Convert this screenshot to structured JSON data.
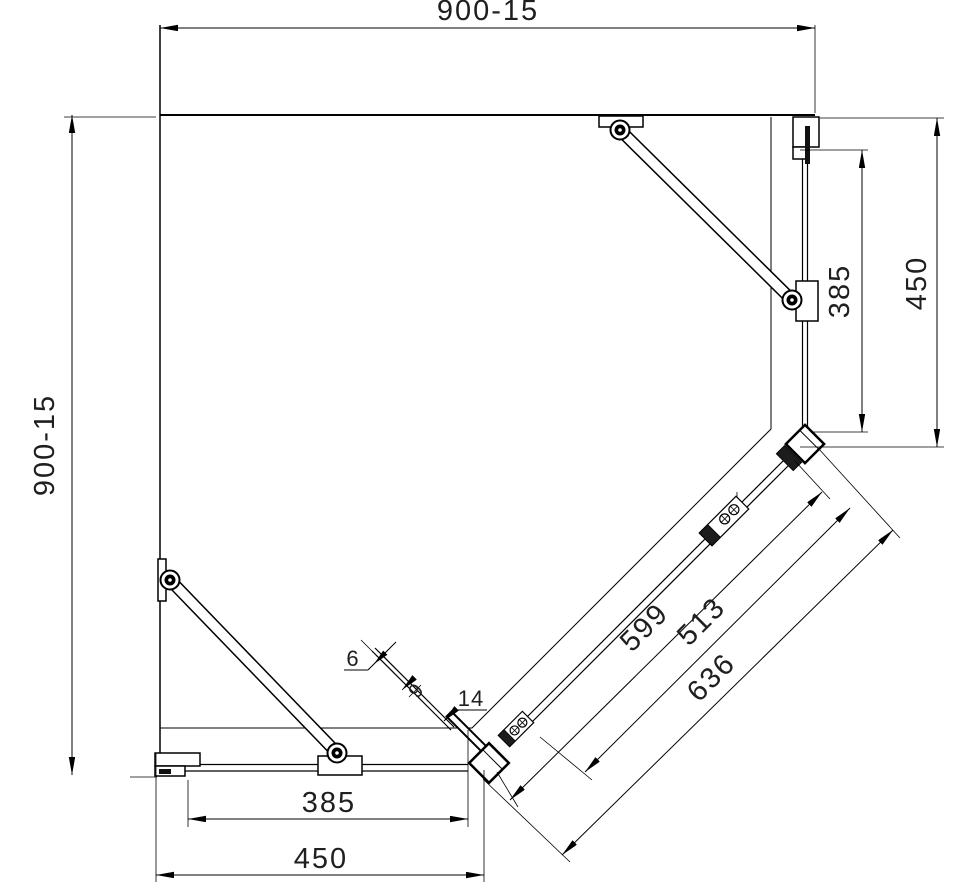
{
  "drawing": {
    "type": "technical-plan-drawing",
    "subject": "pentagon corner shower enclosure plan view",
    "units_implied": "mm",
    "colors": {
      "line": "#000000",
      "background": "#ffffff",
      "text": "#1f1f1f"
    },
    "dimensions": {
      "top_width": "900-15",
      "left_height": "900-15",
      "right_glass_height": "385",
      "right_side_height": "450",
      "bottom_glass_width": "385",
      "bottom_side_width": "450",
      "diagonal_glass_length": "599",
      "diagonal_inner_length": "513",
      "diagonal_overall_length": "636",
      "glass_thickness": "6",
      "door_gap": "9",
      "profile_width": "14"
    }
  }
}
